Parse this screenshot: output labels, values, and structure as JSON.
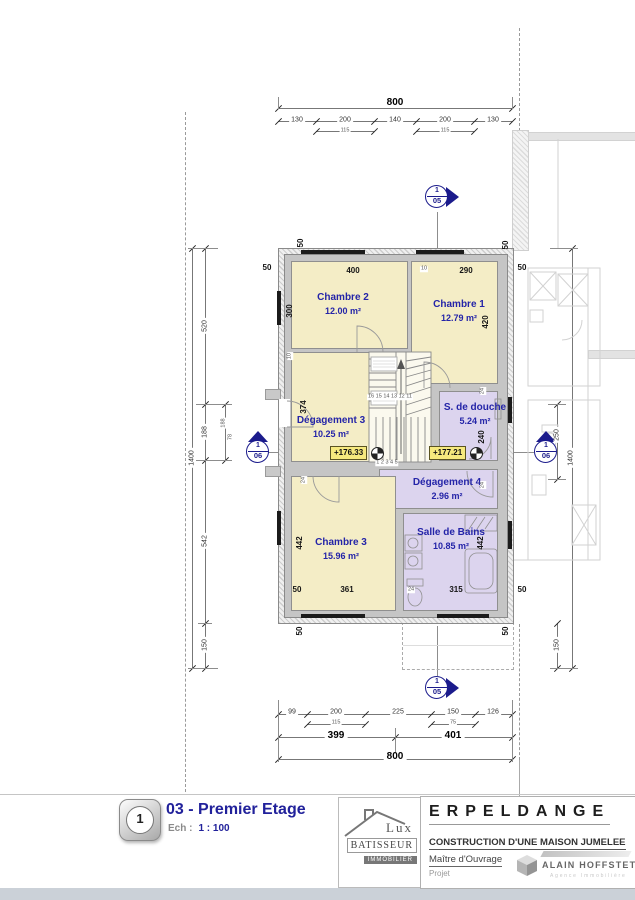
{
  "title_block": {
    "sheet_number": "1",
    "plan_title": "03 - Premier Etage",
    "scale_label": "Ech :",
    "scale_value": "1 : 100",
    "project_name": "ERPELDANGE",
    "project_subtitle": "CONSTRUCTION D'UNE MAISON JUMELEE",
    "owner_label": "Maître d'Ouvrage",
    "project_label": "Projet"
  },
  "logos": {
    "builder": {
      "line1": "Lux",
      "line2": "BATISSEUR",
      "line3": "IMMOBILIER"
    },
    "agency": {
      "name": "ALAIN HOFFSTETTER",
      "subtitle": "Agence Immobilière"
    }
  },
  "plan": {
    "rooms": [
      {
        "slug": "chambre-2",
        "name": "Chambre 2",
        "area": "12.00 m²",
        "rect": [
          12,
          12,
          117,
          88
        ],
        "label": [
          64,
          55
        ],
        "fill": "beige"
      },
      {
        "slug": "chambre-1",
        "name": "Chambre 1",
        "area": "12.79 m²",
        "rect": [
          132,
          12,
          87,
          123
        ],
        "label": [
          180,
          62
        ],
        "fill": "beige"
      },
      {
        "slug": "degagement-3",
        "name": "Dégagement 3",
        "area": "10.25 m²",
        "rect": [
          12,
          103,
          140,
          110
        ],
        "label": [
          52,
          178
        ],
        "fill": "beige"
      },
      {
        "slug": "s-de-douche",
        "name": "S. de douche",
        "area": "5.24 m²",
        "rect": [
          160,
          142,
          59,
          70
        ],
        "label": [
          196,
          165
        ],
        "fill": "violet"
      },
      {
        "slug": "degagement-4",
        "name": "Dégagement 4",
        "area": "2.96 m²",
        "rect": [
          100,
          220,
          119,
          40
        ],
        "label": [
          168,
          240
        ],
        "fill": "violet"
      },
      {
        "slug": "chambre-3",
        "name": "Chambre 3",
        "area": "15.96 m²",
        "rect": [
          12,
          227,
          105,
          135
        ],
        "label": [
          62,
          300
        ],
        "fill": "beige"
      },
      {
        "slug": "salle-de-bains",
        "name": "Salle de Bains",
        "area": "10.85 m²",
        "rect": [
          124,
          264,
          95,
          98
        ],
        "label": [
          172,
          290
        ],
        "fill": "violet"
      }
    ],
    "levels": [
      "+176.33",
      "+177.21"
    ]
  },
  "section_markers": [
    {
      "num": "1",
      "sheet": "05"
    },
    {
      "num": "1",
      "sheet": "05"
    },
    {
      "num": "1",
      "sheet": "06"
    },
    {
      "num": "1",
      "sheet": "06"
    }
  ],
  "dim_labels": [
    {
      "t": "800",
      "x": 395,
      "y": 103,
      "c": "d"
    },
    {
      "t": "130",
      "x": 297,
      "y": 120,
      "c": "a"
    },
    {
      "t": "200",
      "x": 345,
      "y": 120,
      "c": "a"
    },
    {
      "t": "140",
      "x": 395,
      "y": 120,
      "c": "a"
    },
    {
      "t": "200",
      "x": 445,
      "y": 120,
      "c": "a"
    },
    {
      "t": "130",
      "x": 493,
      "y": 120,
      "c": "a"
    },
    {
      "t": "115",
      "x": 345,
      "y": 131,
      "c": "c"
    },
    {
      "t": "115",
      "x": 445,
      "y": 131,
      "c": "c"
    },
    {
      "t": "99",
      "x": 292,
      "y": 712,
      "c": "a"
    },
    {
      "t": "200",
      "x": 336,
      "y": 712,
      "c": "a"
    },
    {
      "t": "225",
      "x": 398,
      "y": 712,
      "c": "a"
    },
    {
      "t": "150",
      "x": 453,
      "y": 712,
      "c": "a"
    },
    {
      "t": "126",
      "x": 493,
      "y": 712,
      "c": "a"
    },
    {
      "t": "115",
      "x": 336,
      "y": 723,
      "c": "c"
    },
    {
      "t": "75",
      "x": 453,
      "y": 723,
      "c": "c"
    },
    {
      "t": "399",
      "x": 336,
      "y": 736,
      "c": "d"
    },
    {
      "t": "401",
      "x": 453,
      "y": 736,
      "c": "d"
    },
    {
      "t": "800",
      "x": 395,
      "y": 757,
      "c": "d"
    },
    {
      "t": "520",
      "x": 205,
      "y": 326,
      "c": "a",
      "r": 1
    },
    {
      "t": "188",
      "x": 205,
      "y": 432,
      "c": "a",
      "r": 1
    },
    {
      "t": "542",
      "x": 205,
      "y": 541,
      "c": "a",
      "r": 1
    },
    {
      "t": "150",
      "x": 205,
      "y": 645,
      "c": "a",
      "r": 1
    },
    {
      "t": "1400",
      "x": 192,
      "y": 458,
      "c": "a",
      "r": 1
    },
    {
      "t": "188",
      "x": 224,
      "y": 423,
      "c": "c",
      "r": 1
    },
    {
      "t": "78",
      "x": 231,
      "y": 437,
      "c": "c",
      "r": 1
    },
    {
      "t": "250",
      "x": 557,
      "y": 435,
      "c": "a",
      "r": 1
    },
    {
      "t": "1400",
      "x": 571,
      "y": 458,
      "c": "a",
      "r": 1
    },
    {
      "t": "150",
      "x": 557,
      "y": 645,
      "c": "a",
      "r": 1
    },
    {
      "t": "50",
      "x": 301,
      "y": 243,
      "c": "e",
      "r": 1
    },
    {
      "t": "50",
      "x": 506,
      "y": 245,
      "c": "e",
      "r": 1
    },
    {
      "t": "50",
      "x": 267,
      "y": 268,
      "c": "e"
    },
    {
      "t": "50",
      "x": 522,
      "y": 268,
      "c": "e"
    },
    {
      "t": "400",
      "x": 353,
      "y": 271,
      "c": "e"
    },
    {
      "t": "10",
      "x": 424,
      "y": 269,
      "c": "c"
    },
    {
      "t": "290",
      "x": 466,
      "y": 271,
      "c": "e"
    },
    {
      "t": "300",
      "x": 290,
      "y": 311,
      "c": "e",
      "r": 1
    },
    {
      "t": "10",
      "x": 290,
      "y": 356,
      "c": "c",
      "r": 1
    },
    {
      "t": "420",
      "x": 486,
      "y": 322,
      "c": "e",
      "r": 1
    },
    {
      "t": "374",
      "x": 304,
      "y": 407,
      "c": "e",
      "r": 1
    },
    {
      "t": "24",
      "x": 304,
      "y": 480,
      "c": "c",
      "r": 1
    },
    {
      "t": "24",
      "x": 483,
      "y": 391,
      "c": "c",
      "r": 1
    },
    {
      "t": "240",
      "x": 482,
      "y": 437,
      "c": "e",
      "r": 1
    },
    {
      "t": "24",
      "x": 483,
      "y": 485,
      "c": "c",
      "r": 1
    },
    {
      "t": "442",
      "x": 300,
      "y": 543,
      "c": "e",
      "r": 1
    },
    {
      "t": "50",
      "x": 297,
      "y": 590,
      "c": "e"
    },
    {
      "t": "361",
      "x": 347,
      "y": 590,
      "c": "e"
    },
    {
      "t": "24",
      "x": 411,
      "y": 590,
      "c": "c"
    },
    {
      "t": "315",
      "x": 456,
      "y": 590,
      "c": "e"
    },
    {
      "t": "442",
      "x": 481,
      "y": 543,
      "c": "e",
      "r": 1
    },
    {
      "t": "50",
      "x": 300,
      "y": 631,
      "c": "e",
      "r": 1
    },
    {
      "t": "50",
      "x": 506,
      "y": 631,
      "c": "e",
      "r": 1
    },
    {
      "t": "50",
      "x": 522,
      "y": 590,
      "c": "e"
    },
    {
      "t": "16 15 14 13 12 11",
      "x": 390,
      "y": 397,
      "c": "c"
    },
    {
      "t": "1 2 3 4 5",
      "x": 387,
      "y": 463,
      "c": "c"
    }
  ]
}
